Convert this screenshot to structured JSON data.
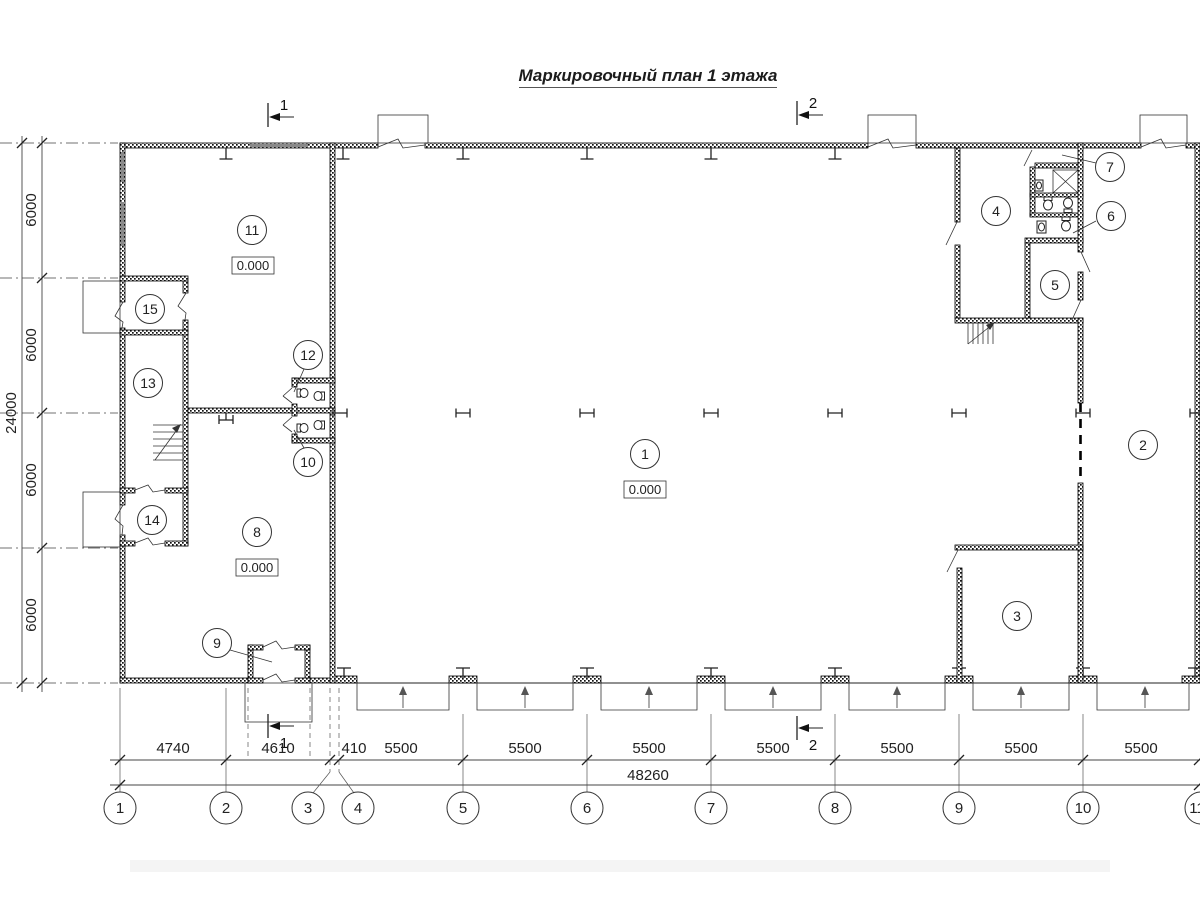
{
  "title": "Маркировочный план 1 этажа",
  "section_marks": {
    "s1": "1",
    "s2": "2"
  },
  "rooms": [
    "1",
    "2",
    "3",
    "4",
    "5",
    "6",
    "7",
    "8",
    "9",
    "10",
    "11",
    "12",
    "13",
    "14",
    "15"
  ],
  "elevations": [
    "0.000",
    "0.000",
    "0.000"
  ],
  "dims_bottom": [
    "4740",
    "4610",
    "410",
    "5500",
    "5500",
    "5500",
    "5500",
    "5500",
    "5500",
    "5500"
  ],
  "dim_total_bottom": "48260",
  "dims_left": [
    "6000",
    "6000",
    "6000",
    "6000"
  ],
  "dim_total_left": "24000",
  "grid_bubbles": [
    "1",
    "2",
    "3",
    "4",
    "5",
    "6",
    "7",
    "8",
    "9",
    "10",
    "11"
  ]
}
